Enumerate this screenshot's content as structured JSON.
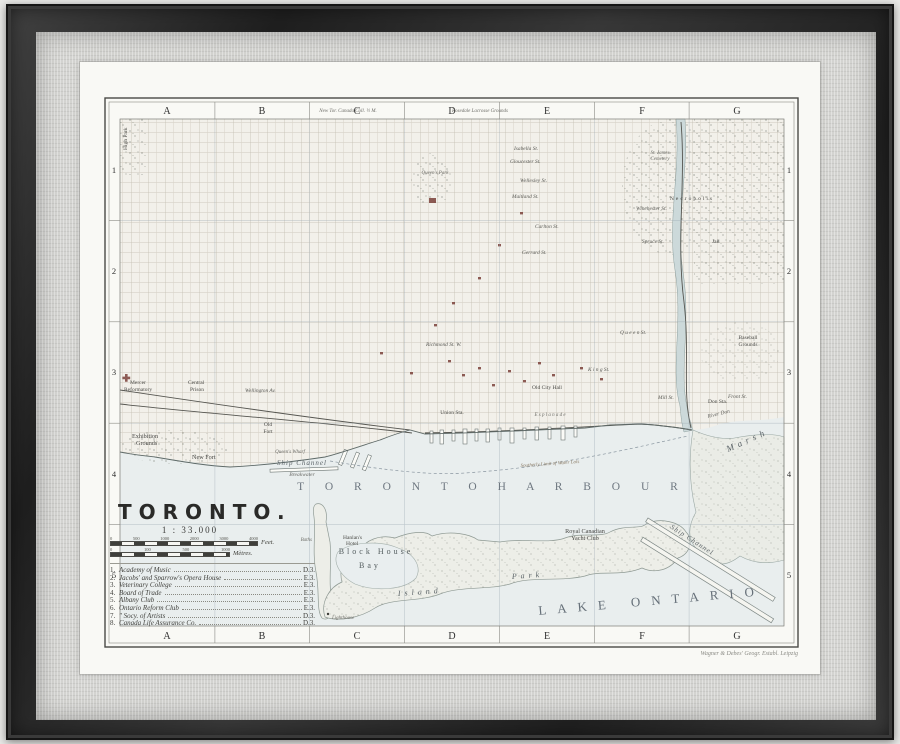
{
  "artwork": {
    "map_title": "TORONTO.",
    "map_scale": "1 : 33.000"
  },
  "grid": {
    "columns": [
      "A",
      "B",
      "C",
      "D",
      "E",
      "F",
      "G"
    ],
    "rows": [
      "1",
      "2",
      "3",
      "4",
      "5"
    ]
  },
  "scalebar": {
    "feet_ticks": [
      "0",
      "500",
      "1000",
      "2000",
      "3000",
      "4000"
    ],
    "feet_unit": "Feet.",
    "metre_ticks": [
      "0",
      "100",
      "500",
      "1000"
    ],
    "metre_unit": "Mètres."
  },
  "legend": [
    {
      "num": "1.",
      "name": "Academy of Music",
      "ref": "D.3."
    },
    {
      "num": "2.",
      "name": "Jacobs' and Sparrow's Opera House",
      "ref": "E.3."
    },
    {
      "num": "3.",
      "name": "Veterinary College",
      "ref": "E.3."
    },
    {
      "num": "4.",
      "name": "Board of Trade",
      "ref": "E.3."
    },
    {
      "num": "5.",
      "name": "Albany Club",
      "ref": "E.3."
    },
    {
      "num": "6.",
      "name": "Ontario Reform Club",
      "ref": "E.3."
    },
    {
      "num": "7.",
      "name": "″  Socy. of Artists",
      "ref": "D.3."
    },
    {
      "num": "8.",
      "name": "Canada Life Assurance Co.",
      "ref": "D.3."
    }
  ],
  "water": {
    "toronto_harbour": "T O R O N T O     H A R B O U R",
    "lake_ontario": "LAKE ONTARIO",
    "southerly_limit": "Southerly Limit of Water Lots",
    "block_house": "Block House",
    "bay": "Bay",
    "ship_channel_west": "Ship Channel",
    "breakwater": "Breakwater",
    "ship_channel_east": "Ship Channel",
    "river_don": "River Don",
    "marsh": "M a r s h",
    "island": "I s l a n d",
    "park": "P a r k"
  },
  "places": {
    "high_park": "High Park",
    "exhibition_1": "Exhibition",
    "exhibition_2": "Grounds",
    "new_fort": "New Fort",
    "old_fort_1": "Old",
    "old_fort_2": "Fort",
    "queens_wharf": "Queen's Wharf",
    "mercer_1": "Mercer",
    "mercer_2": "Reformatory",
    "prison_1": "Central",
    "prison_2": "Prison",
    "queens_park": "Queen's Park",
    "union_station": "Union Sta.",
    "esplanade": "E s p l a n a d e",
    "old_city_hall": "Old City Hall",
    "baths": "Baths",
    "hanlans_1": "Hanlan's",
    "hanlans_2": "Hotel",
    "lighthouse": "Lighthouse",
    "rcyc_1": "Royal Canadian",
    "rcyc_2": "Yacht Club",
    "baseball_1": "Baseball",
    "baseball_2": "Grounds",
    "necropolis": "Necropolis",
    "st_james_1": "St. James",
    "st_james_2": "Cemetery",
    "jail": "Jail",
    "don_station": "Don Sta."
  },
  "streets": {
    "queen": "Q u e e n  St.",
    "king": "K i n g  St.",
    "richmond": "Richmond St. W.",
    "wellington": "Wellington Av.",
    "front": "Front St.",
    "mill": "Mill St.",
    "wellesley": "Wellesley St.",
    "maitland": "Maitland St.",
    "gloucester": "Gloucester St.",
    "isabella": "Isabella St.",
    "carlton": "Carlton St.",
    "gerrard": "Gerrard St.",
    "winchester": "Winchester St.",
    "spruce": "Spruce St."
  },
  "annotations": {
    "canada_college": "New Tor. Canada Coll. ½ M.",
    "lacrosse_grounds": "Rosedale Lacrosse Grounds",
    "imprint": "Wagner & Debes' Geogr. Establ. Leipzig"
  }
}
